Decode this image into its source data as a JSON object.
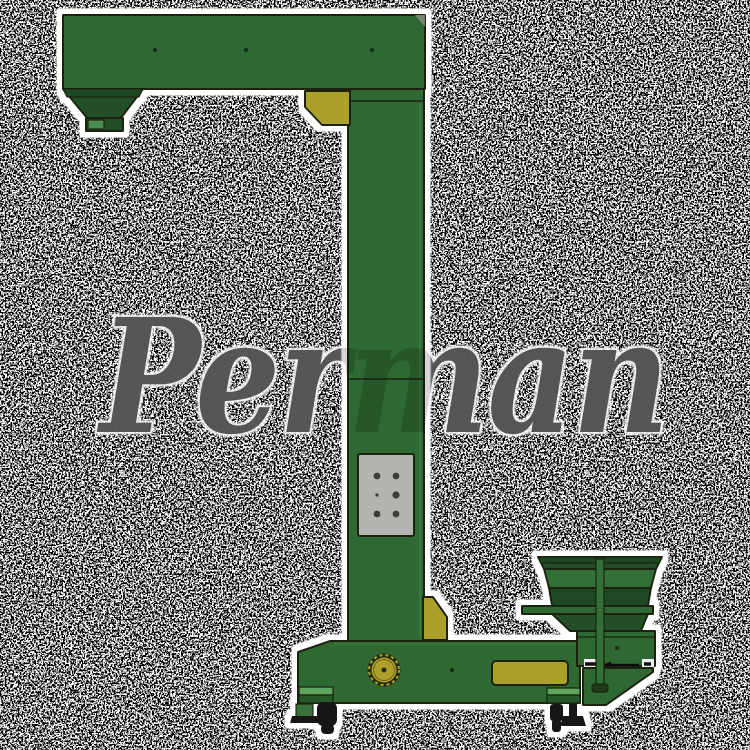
{
  "image": {
    "kind": "watermarked product render",
    "subject": "Z-type vertical bucket elevator with discharge arm, feed hopper and wheeled base",
    "background_style": "black field covered in white speckle noise"
  },
  "watermark": {
    "text": "Perman",
    "color": "#0a0a0a"
  },
  "colors": {
    "noise_bg": "#020202",
    "noise_dots": "#ffffff",
    "halo": "#ffffff",
    "body": "#2e6833",
    "body_mid": "#336f38",
    "body_dark": "#234f27",
    "band_dark": "#1d4a22",
    "step_light": "#5ea45f",
    "edge_light": "#3f7d44",
    "yellow": "#ada02b",
    "panel_gray": "#b4b4b0",
    "hole": "#3c3c34",
    "outline": "#1a240f",
    "black_parts": "#121212"
  },
  "parts": {
    "discharge_arm": "top horizontal discharge arm",
    "discharge_hopper": "left discharge outlet hopper",
    "column": "vertical elevator column",
    "access_panel": "gray access panel with bolt holes",
    "feed_hopper": "right feed hopper on stand",
    "base": "wheeled base frame",
    "pulley": "yellow drive pulley",
    "casters": "black caster wheels and leveling feet"
  }
}
